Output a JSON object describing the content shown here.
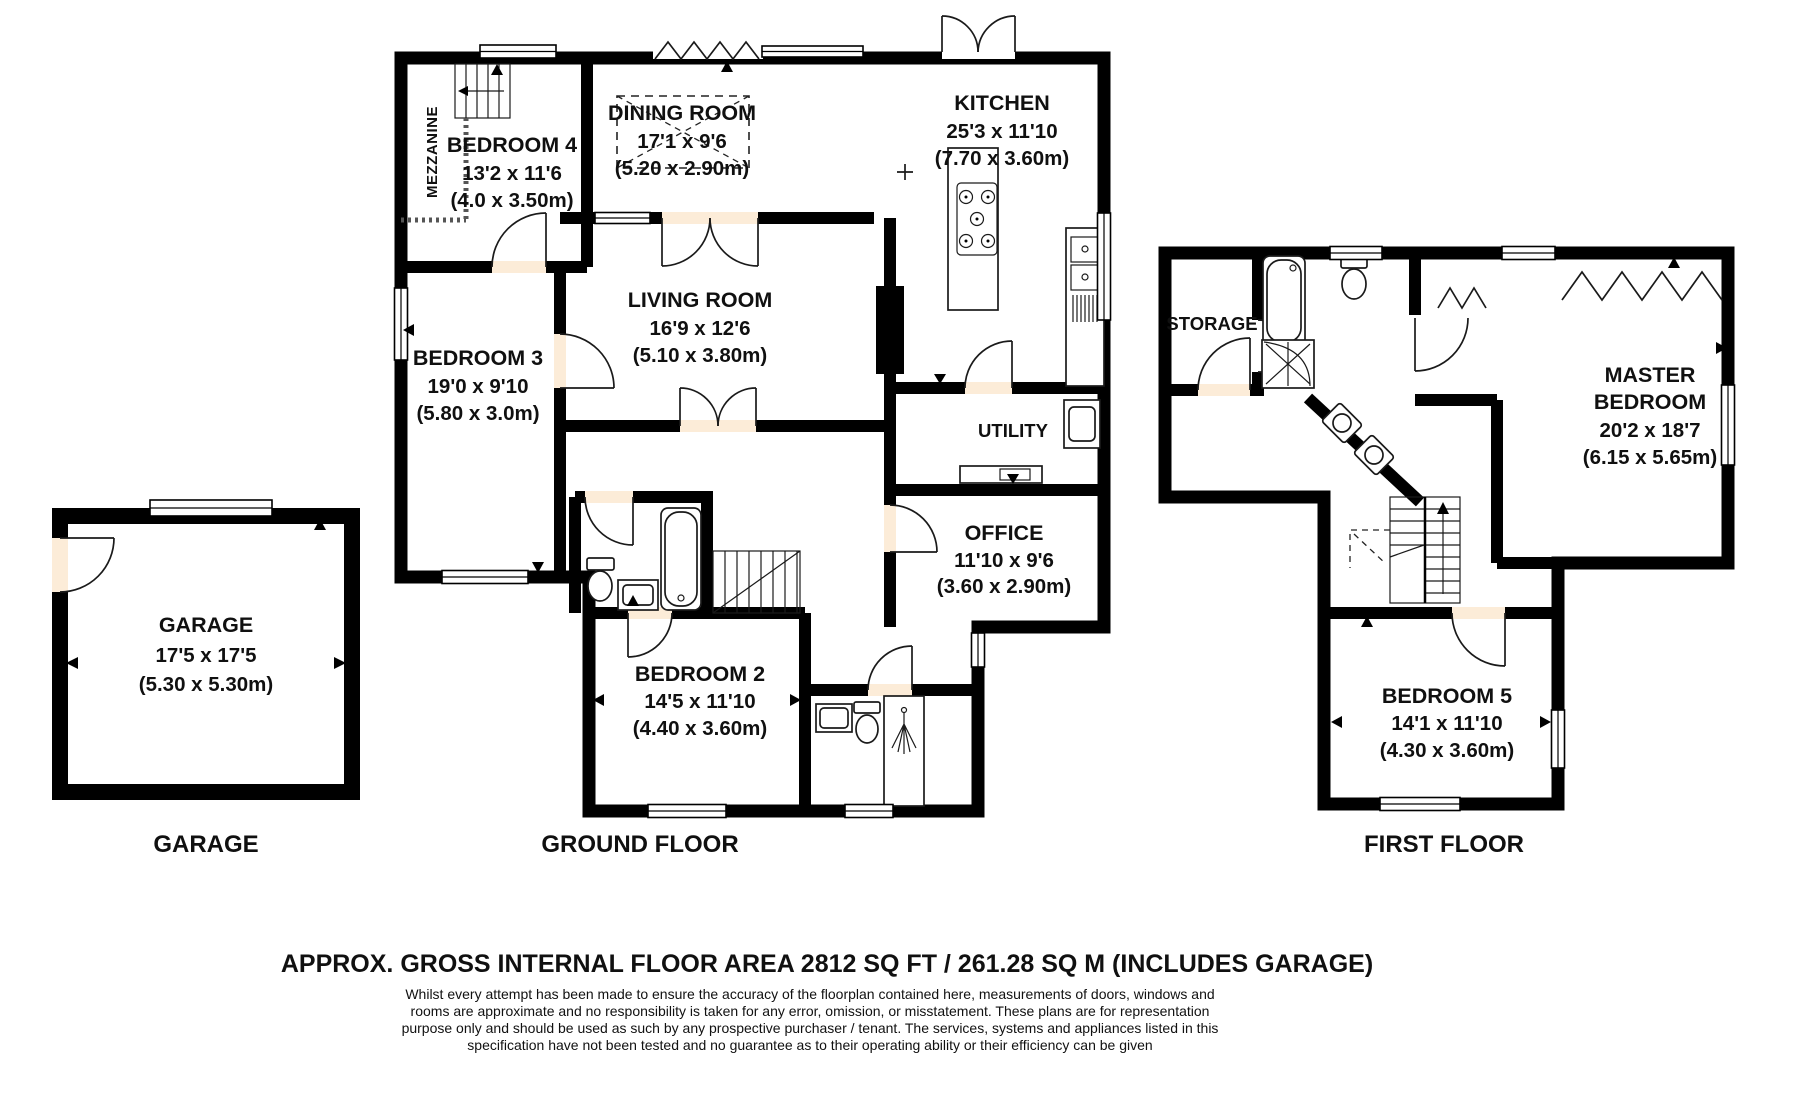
{
  "document": {
    "rooms": {
      "garage": {
        "name": "GARAGE",
        "imperial": "17'5 x 17'5",
        "metric": "(5.30 x 5.30m)"
      },
      "bedroom4": {
        "name": "BEDROOM 4",
        "imperial": "13'2 x 11'6",
        "metric": "(4.0 x 3.50m)"
      },
      "mezzanine": {
        "name": "MEZZANINE"
      },
      "dining": {
        "name": "DINING ROOM",
        "imperial": "17'1 x 9'6",
        "metric": "(5.20 x 2.90m)"
      },
      "kitchen": {
        "name": "KITCHEN",
        "imperial": "25'3 x 11'10",
        "metric": "(7.70 x 3.60m)"
      },
      "bedroom3": {
        "name": "BEDROOM 3",
        "imperial": "19'0 x 9'10",
        "metric": "(5.80 x 3.0m)"
      },
      "living": {
        "name": "LIVING ROOM",
        "imperial": "16'9 x 12'6",
        "metric": "(5.10 x 3.80m)"
      },
      "utility": {
        "name": "UTILITY"
      },
      "office": {
        "name": "OFFICE",
        "imperial": "11'10 x 9'6",
        "metric": "(3.60 x 2.90m)"
      },
      "bedroom2": {
        "name": "BEDROOM 2",
        "imperial": "14'5 x 11'10",
        "metric": "(4.40 x 3.60m)"
      },
      "storage": {
        "name": "STORAGE"
      },
      "master": {
        "name_line1": "MASTER",
        "name_line2": "BEDROOM",
        "imperial": "20'2 x 18'7",
        "metric": "(6.15 x 5.65m)"
      },
      "bedroom5": {
        "name": "BEDROOM 5",
        "imperial": "14'1 x 11'10",
        "metric": "(4.30 x 3.60m)"
      }
    },
    "floor_labels": {
      "garage": "GARAGE",
      "ground": "GROUND FLOOR",
      "first": "FIRST FLOOR"
    },
    "footer": {
      "area_title": "APPROX. GROSS INTERNAL FLOOR AREA 2812 SQ FT / 261.28 SQ M (INCLUDES GARAGE)",
      "disclaimer_lines": [
        "Whilst every attempt has been made to ensure the accuracy of the floorplan contained here, measurements of doors, windows and",
        "rooms are approximate and no responsibility is taken for any error, omission, or misstatement. These plans are for representation",
        "purpose only and should be used as such by any prospective purchaser / tenant. The services, systems and appliances listed in this",
        "specification have not been tested and no guarantee as to their operating ability or their efficiency can be given"
      ]
    },
    "colors": {
      "room_fill": "#fcecd8",
      "wall": "#000000",
      "background": "#ffffff"
    }
  }
}
